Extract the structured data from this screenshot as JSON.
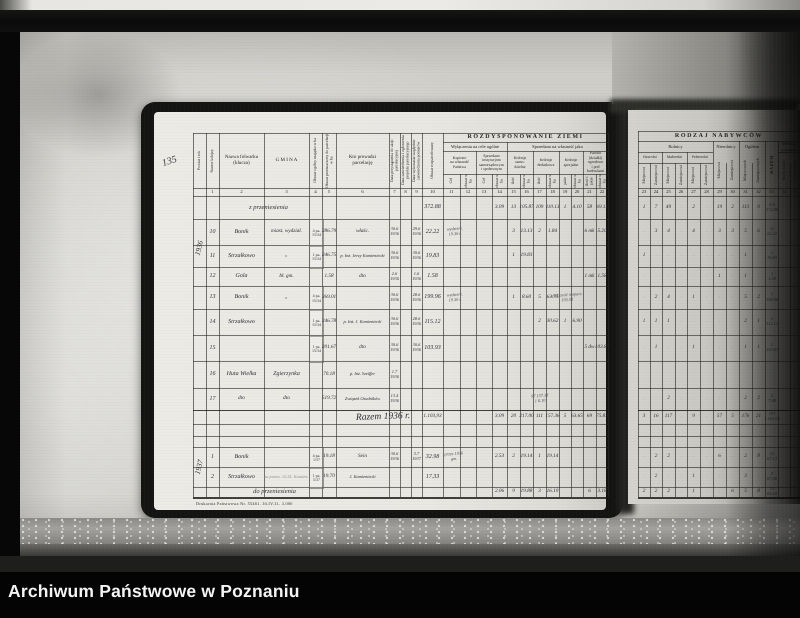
{
  "caption": {
    "title": "Archiwum Państwowe w Poznaniu"
  },
  "photo": {
    "margin_note": "135",
    "print_footer": "Drukarnia Państwowa Nr. 55481.  30.IV.31.  3.000"
  },
  "left_page": {
    "title_band": "ROZDYSPONOWANIE ZIEMI",
    "sub_bands": [
      "Wyłączenia na cele ogólne",
      "Sprzedano na własność jako"
    ],
    "col_labels": [
      "Powiat i rok",
      "Numer kolejny",
      "Nazwa folwarku\n(klucza)",
      "G M I N A",
      "Obszar ogólny majątku w ha",
      "Obszar przeznaczony do parcelacji w ha",
      "Kto prowadzi\nparcelację",
      "Data przystąpienia do akcji parcelacyjnej",
      "Data zatwierdzenia i ogłoszenia projektu parcelacyjnego",
      "Data wykonania względnie zatwierdzenia pomiarów",
      "Obszar rozparcelowany"
    ],
    "group_labels": [
      "Kupiono\nna własność\nPaństwa",
      "Sprzedano\ninstytucjom\nsamorządowym\ni społecznym",
      "Kolonje\nsamo-\ndzielne",
      "Kolonje\ndodatkowe",
      "Kolonje\nspecjalne",
      "Parcele\n(działki)\nogrodowe\ni pod\nbudowlami"
    ],
    "unit_labels": [
      "Cel",
      "obszar w ha",
      "Cel",
      "obszar w ha",
      "ilość",
      "obszar w ha",
      "ilość",
      "obszar w ha",
      "jakie",
      "obszar w ha",
      "ilość i jakie",
      "obszar w ha"
    ],
    "col_numbers": [
      "",
      "1",
      "2",
      "3",
      "4",
      "5",
      "6",
      "7",
      "8",
      "9",
      "10",
      "11",
      "12",
      "13",
      "14",
      "15",
      "16",
      "17",
      "18",
      "19",
      "20",
      "21",
      "22"
    ],
    "rows": [
      [
        {
          "c": "gm",
          "t": "z przeniesienia",
          "k": "wide",
          "w": 90,
          "dx": -18
        },
        {
          "c": "roz",
          "t": "372.88"
        },
        {
          "c": "c14",
          "t": "3.09",
          "k": "sm"
        },
        {
          "c": "c15",
          "t": "13",
          "k": "sm"
        },
        {
          "c": "c16",
          "t": "105.87",
          "k": "sm"
        },
        {
          "c": "c17",
          "t": "109",
          "k": "sm"
        },
        {
          "c": "c18",
          "t": "110.13",
          "k": "sm"
        },
        {
          "c": "c19",
          "t": "1",
          "k": "sm"
        },
        {
          "c": "c20",
          "t": "4.10",
          "k": "sm"
        },
        {
          "c": "c21",
          "t": "58",
          "k": "sm"
        },
        {
          "c": "c22",
          "t": "69.11",
          "k": "sm"
        }
      ],
      [
        {
          "c": "p",
          "t": "1936",
          "k": "vert",
          "h": 58
        },
        {
          "c": "n",
          "t": "10"
        },
        {
          "c": "naz",
          "t": "Bonik"
        },
        {
          "c": "gm",
          "t": "miast. wydział.",
          "k": "sm"
        },
        {
          "c": "ob",
          "t": "4 pa.\n15/34",
          "k": "stamp"
        },
        {
          "c": "prz",
          "t": "286.79",
          "k": "sm"
        },
        {
          "c": "kto",
          "t": "właśc.",
          "k": "sm"
        },
        {
          "c": "d1",
          "t": "30.6\n1936",
          "k": "xs"
        },
        {
          "c": "d3",
          "t": "29.6\n1936",
          "k": "xs"
        },
        {
          "c": "roz",
          "t": "22.22"
        },
        {
          "c": "c11",
          "t": "wydzierż.\n19.36 r.",
          "k": "note",
          "w": 42,
          "dx": 3
        },
        {
          "c": "c15",
          "t": "3",
          "k": "sm"
        },
        {
          "c": "c16",
          "t": "13.13",
          "k": "sm"
        },
        {
          "c": "c17",
          "t": "2",
          "k": "sm"
        },
        {
          "c": "c18",
          "t": "1.84",
          "k": "sm"
        },
        {
          "c": "c21",
          "t": "6 mk",
          "k": "sm"
        },
        {
          "c": "c22",
          "t": "5.20",
          "k": "sm"
        }
      ],
      [
        {
          "c": "n",
          "t": "11"
        },
        {
          "c": "naz",
          "t": "Strzałkowo"
        },
        {
          "c": "gm",
          "t": "„",
          "k": "sm"
        },
        {
          "c": "ob",
          "t": "1 pa.\n15/34",
          "k": "stamp"
        },
        {
          "c": "prz",
          "t": "246.75",
          "k": "sm"
        },
        {
          "c": "kto",
          "t": "p. Inż. Jerzy Kamieniecki",
          "k": "xs"
        },
        {
          "c": "d1",
          "t": "30.6\n1936",
          "k": "xs"
        },
        {
          "c": "d3",
          "t": "30.6\n1936",
          "k": "xs"
        },
        {
          "c": "roz",
          "t": "19.83"
        },
        {
          "c": "c15",
          "t": "1",
          "k": "sm"
        },
        {
          "c": "c16",
          "t": "19.83",
          "k": "sm"
        }
      ],
      [
        {
          "c": "n",
          "t": "12"
        },
        {
          "c": "naz",
          "t": "Gola"
        },
        {
          "c": "gm",
          "t": "bł. gm.",
          "k": "sm"
        },
        {
          "c": "prz",
          "t": "1.58",
          "k": "sm"
        },
        {
          "c": "kto",
          "t": "dto",
          "k": "sm"
        },
        {
          "c": "d1",
          "t": "2.6\n1936",
          "k": "xs"
        },
        {
          "c": "d3",
          "t": "1.6\n1936",
          "k": "xs"
        },
        {
          "c": "roz",
          "t": "1.58"
        },
        {
          "c": "c21",
          "t": "1 mk",
          "k": "sm"
        },
        {
          "c": "c22",
          "t": "1.58",
          "k": "sm"
        }
      ],
      [
        {
          "c": "n",
          "t": "13"
        },
        {
          "c": "naz",
          "t": "Bonik"
        },
        {
          "c": "gm",
          "t": "„",
          "k": "sm"
        },
        {
          "c": "ob",
          "t": "4 pa.\n15/34",
          "k": "stamp"
        },
        {
          "c": "prz",
          "t": "269.01",
          "k": "sm"
        },
        {
          "c": "d1",
          "t": "30.6\n1936",
          "k": "xs"
        },
        {
          "c": "d3",
          "t": "28.6\n1936",
          "k": "xs"
        },
        {
          "c": "roz",
          "t": "199.96"
        },
        {
          "c": "c11",
          "t": "wydzierż.\n19.36 r.",
          "k": "note",
          "w": 42,
          "dx": 3
        },
        {
          "c": "c15",
          "t": "1",
          "k": "sm"
        },
        {
          "c": "c16",
          "t": "8.60",
          "k": "sm"
        },
        {
          "c": "c17",
          "t": "5",
          "k": "sm"
        },
        {
          "c": "c18",
          "t": "63.75",
          "k": "sm"
        },
        {
          "c": "c19",
          "t": "większość rozparc.\n193.58",
          "k": "note",
          "w": 48,
          "dx": 2
        }
      ],
      [
        {
          "c": "n",
          "t": "14"
        },
        {
          "c": "naz",
          "t": "Strzałkowo"
        },
        {
          "c": "ob",
          "t": "1 pa.\n15/34",
          "k": "stamp"
        },
        {
          "c": "prz",
          "t": "246.78",
          "k": "sm"
        },
        {
          "c": "kto",
          "t": "p. Inż. J. Kamieniecki",
          "k": "xs"
        },
        {
          "c": "d1",
          "t": "30.6\n1936",
          "k": "xs"
        },
        {
          "c": "d3",
          "t": "28.6\n1936",
          "k": "xs"
        },
        {
          "c": "roz",
          "t": "115.12"
        },
        {
          "c": "c17",
          "t": "2",
          "k": "sm"
        },
        {
          "c": "c18",
          "t": "30.62",
          "k": "sm"
        },
        {
          "c": "c19",
          "t": "1",
          "k": "sm"
        },
        {
          "c": "c20",
          "t": "6.90",
          "k": "sm"
        }
      ],
      [
        {
          "c": "n",
          "t": "15"
        },
        {
          "c": "ob",
          "t": "1 pa.\n15/34",
          "k": "stamp"
        },
        {
          "c": "prz",
          "t": "201.67",
          "k": "sm"
        },
        {
          "c": "kto",
          "t": "dto",
          "k": "sm"
        },
        {
          "c": "d1",
          "t": "30.6\n1936",
          "k": "xs"
        },
        {
          "c": "d3",
          "t": "30.6\n1936",
          "k": "xs"
        },
        {
          "c": "roz",
          "t": "103.93"
        },
        {
          "c": "c21",
          "t": "5 dw",
          "k": "sm"
        },
        {
          "c": "c22",
          "t": "103.87",
          "k": "sm"
        }
      ],
      [
        {
          "c": "n",
          "t": "16"
        },
        {
          "c": "naz",
          "t": "Huta Wielka"
        },
        {
          "c": "gm",
          "t": "Zgierzynka"
        },
        {
          "c": "prz",
          "t": "70.18",
          "k": "sm"
        },
        {
          "c": "kto",
          "t": "p. Inż. Szeiffer",
          "k": "xs"
        },
        {
          "c": "d1",
          "t": "1.7\n1936",
          "k": "xs"
        }
      ],
      [
        {
          "c": "n",
          "t": "17"
        },
        {
          "c": "naz",
          "t": "dto",
          "k": "sm"
        },
        {
          "c": "gm",
          "t": "dto",
          "k": "sm"
        },
        {
          "c": "prz",
          "t": "519.72",
          "k": "sm"
        },
        {
          "c": "kto",
          "t": "Związek Osadników",
          "k": "xs"
        },
        {
          "c": "d1",
          "t": "13.4\n1936",
          "k": "xs"
        },
        {
          "c": "c17",
          "t": "97  157.38\n1      6.10",
          "k": "note",
          "w": 34
        }
      ],
      [
        {
          "c": "kto",
          "t": "Razem 1936 r.",
          "k": "script",
          "w": 110,
          "dx": 20
        },
        {
          "c": "roz",
          "t": "1.103,93",
          "k": "sm"
        },
        {
          "c": "c14",
          "t": "3.09",
          "k": "sm"
        },
        {
          "c": "c15",
          "t": "20",
          "k": "sm"
        },
        {
          "c": "c16",
          "t": "217.00",
          "k": "sm"
        },
        {
          "c": "c17",
          "t": "111",
          "k": "sm"
        },
        {
          "c": "c18",
          "t": "157.36",
          "k": "sm"
        },
        {
          "c": "c19",
          "t": "5",
          "k": "sm"
        },
        {
          "c": "c20",
          "t": "63.65",
          "k": "sm"
        },
        {
          "c": "c21",
          "t": "69",
          "k": "sm"
        },
        {
          "c": "c22",
          "t": "75.83",
          "k": "sm"
        }
      ],
      [],
      [],
      [
        {
          "c": "p",
          "t": "1937",
          "k": "vert",
          "h": 40
        },
        {
          "c": "n",
          "t": "1"
        },
        {
          "c": "naz",
          "t": "Bonik"
        },
        {
          "c": "ob",
          "t": "4 pa.\n1/37",
          "k": "stamp"
        },
        {
          "c": "prz",
          "t": "19.18",
          "k": "sm"
        },
        {
          "c": "kto",
          "t": "Sein",
          "k": "sm"
        },
        {
          "c": "d1",
          "t": "30.6\n1936",
          "k": "xs"
        },
        {
          "c": "d3",
          "t": "5.7\n1937",
          "k": "xs"
        },
        {
          "c": "roz",
          "t": "32.98"
        },
        {
          "c": "c11",
          "t": "przez 1936\ngm.",
          "k": "note",
          "w": 36,
          "dx": 2
        },
        {
          "c": "c14",
          "t": "2.53",
          "k": "sm"
        },
        {
          "c": "c15",
          "t": "2",
          "k": "sm"
        },
        {
          "c": "c16",
          "t": "19.14",
          "k": "sm"
        },
        {
          "c": "c17",
          "t": "1",
          "k": "sm"
        },
        {
          "c": "c18",
          "t": "19.14",
          "k": "sm"
        }
      ],
      [
        {
          "c": "n",
          "t": "2"
        },
        {
          "c": "naz",
          "t": "Strzałkowo"
        },
        {
          "c": "gm",
          "t": "za przew. 10.IX. Kamien.",
          "k": "pencil",
          "w": 72
        },
        {
          "c": "ob",
          "t": "1 pa.\n5/37",
          "k": "stamp"
        },
        {
          "c": "prz",
          "t": "19.70",
          "k": "sm"
        },
        {
          "c": "kto",
          "t": "J. Kamieniecki",
          "k": "xs"
        },
        {
          "c": "roz",
          "t": "17.33"
        }
      ],
      [
        {
          "c": "gm",
          "t": "do przeniesienia",
          "k": "wide",
          "w": 90,
          "dx": -12
        },
        {
          "c": "c14",
          "t": "2.06",
          "k": "sm"
        },
        {
          "c": "c15",
          "t": "9",
          "k": "sm"
        },
        {
          "c": "c16",
          "t": "19.88",
          "k": "sm"
        },
        {
          "c": "c17",
          "t": "3",
          "k": "sm"
        },
        {
          "c": "c18",
          "t": "16.10",
          "k": "sm"
        },
        {
          "c": "c21",
          "t": "6",
          "k": "sm"
        },
        {
          "c": "c22",
          "t": "3.18",
          "k": "sm"
        }
      ]
    ]
  },
  "right_page": {
    "title_band": "RODZAJ NABYWCÓW",
    "group_labels": [
      "Rolnicy",
      "Nierolnicy",
      "Ogółem",
      "Według wyznania"
    ],
    "sub_group_labels": [
      "Bezrolni",
      "Małorolni",
      "Pełnorolni"
    ],
    "col_labels": [
      "Miejscowi",
      "Zamiejscowi",
      "Miejscowi",
      "Zamiejscowi",
      "Miejscowi",
      "Zamiejscowi",
      "Miejscowi",
      "Zamiejscowi",
      "Miejscowych",
      "Zamiejscowych",
      "RAZEM",
      "Rzym.-katol.",
      "Grecko-katol."
    ],
    "col_numbers": [
      "23",
      "24",
      "25",
      "26",
      "27",
      "28",
      "29",
      "30",
      "31",
      "32",
      "33",
      "34",
      "35"
    ],
    "rows": [
      {
        "v": [
          "1",
          "7",
          "49",
          "",
          "2",
          "",
          "19",
          "2",
          "113",
          "9"
        ],
        "rz": "114\n372.88"
      },
      {
        "v": [
          "",
          "3",
          "4",
          "",
          "4",
          "",
          "3",
          "3",
          "5",
          "6"
        ],
        "rz": "11\n22.22"
      },
      {
        "v": [
          "1",
          "",
          "",
          "",
          "",
          "",
          "",
          "",
          "1",
          ""
        ],
        "rz": "1\n19.83"
      },
      {
        "v": [
          "",
          "",
          "",
          "",
          "",
          "",
          "1",
          "",
          "1",
          ""
        ],
        "rz": "1\n1.58"
      },
      {
        "v": [
          "",
          "2",
          "4",
          "",
          "1",
          "",
          "",
          "",
          "5",
          "2"
        ],
        "rz": "7\n199.96"
      },
      {
        "v": [
          "1",
          "1",
          "1",
          "",
          "",
          "",
          "",
          "",
          "2",
          "1"
        ],
        "rz": "3\n115.12"
      },
      {
        "v": [
          "",
          "1",
          "",
          "",
          "1",
          "",
          "",
          "",
          "1",
          "1"
        ],
        "rz": "1\n103.87"
      },
      {
        "v": [
          "",
          "",
          "",
          "",
          "",
          "",
          "",
          "",
          "",
          ""
        ],
        "rz": ""
      },
      {
        "v": [
          "",
          "",
          "2",
          "",
          "",
          "",
          "",
          "",
          "2",
          "2"
        ],
        "rz": "2\n7.88"
      },
      {
        "v": [
          "3",
          "16",
          "117",
          "",
          "9",
          "",
          "57",
          "5",
          "176",
          "21"
        ],
        "rz": "197\n1.103,93"
      },
      {
        "v": [
          "",
          "",
          "",
          "",
          "",
          "",
          "",
          "",
          "",
          ""
        ],
        "rz": ""
      },
      {
        "v": [
          "",
          "",
          "",
          "",
          "",
          "",
          "",
          "",
          "",
          ""
        ],
        "rz": ""
      },
      {
        "v": [
          "",
          "2",
          "2",
          "",
          "",
          "",
          "6",
          "",
          "2",
          "8"
        ],
        "rz": "10\n67.13"
      },
      {
        "v": [
          "",
          "2",
          "",
          "",
          "1",
          "",
          "",
          "",
          "3",
          ""
        ],
        "rz": "3\n87.08"
      },
      {
        "v": [
          "2",
          "2",
          "2",
          "",
          "1",
          "",
          "",
          "6",
          "5",
          "8"
        ],
        "rz": "13\n69.44"
      }
    ]
  }
}
